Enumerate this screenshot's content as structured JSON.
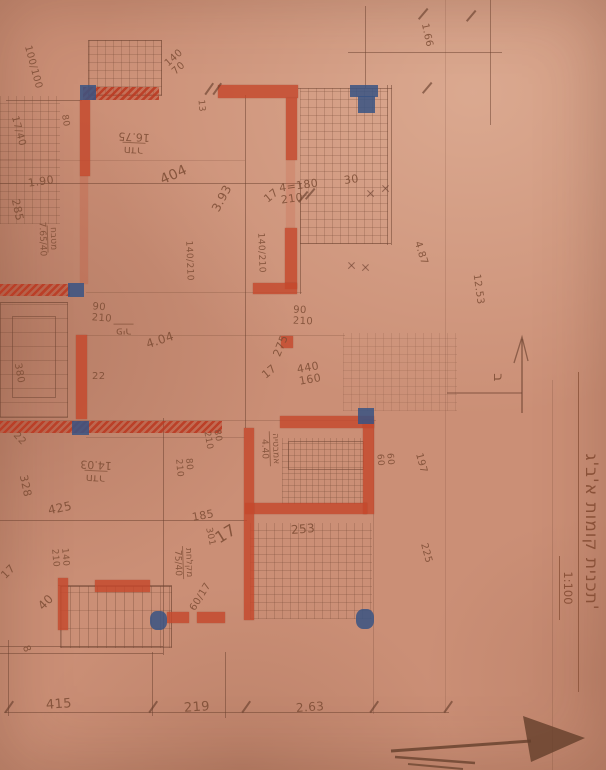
{
  "title_block": {
    "title": "תכנית קומות א'ב'ג'",
    "scale": "1:100"
  },
  "north": {
    "label": "ב"
  },
  "rooms": [
    {
      "name": "חדר",
      "area": "16.75"
    },
    {
      "name": "חדר",
      "area": "14.03"
    },
    {
      "name": "פיר",
      "area": ""
    },
    {
      "name": "מטבח",
      "area": "7.65/40"
    },
    {
      "name": "אמבטיה",
      "area": "4.40"
    },
    {
      "name": "מקלחת",
      "area": "75/40"
    }
  ],
  "openings": [
    "100/100",
    "140\n70",
    "4=180\n210",
    "90\n210",
    "140/210",
    "140/210",
    "90\n210",
    "80\n210",
    "80\n210",
    "440\n160",
    "60\n60",
    "140\n210",
    "17/40",
    "60/17"
  ],
  "dims": [
    "1.90",
    "285",
    "80",
    "404",
    "3.93",
    "30",
    "1.66",
    "12.53",
    "4.87",
    "197",
    "225",
    "275",
    "4.04",
    "22",
    "22",
    "380",
    "328",
    "425",
    "185",
    "301",
    "253",
    "415",
    "219",
    "2.63",
    "13",
    "17",
    "17",
    "17",
    "17",
    "40",
    "8"
  ]
}
